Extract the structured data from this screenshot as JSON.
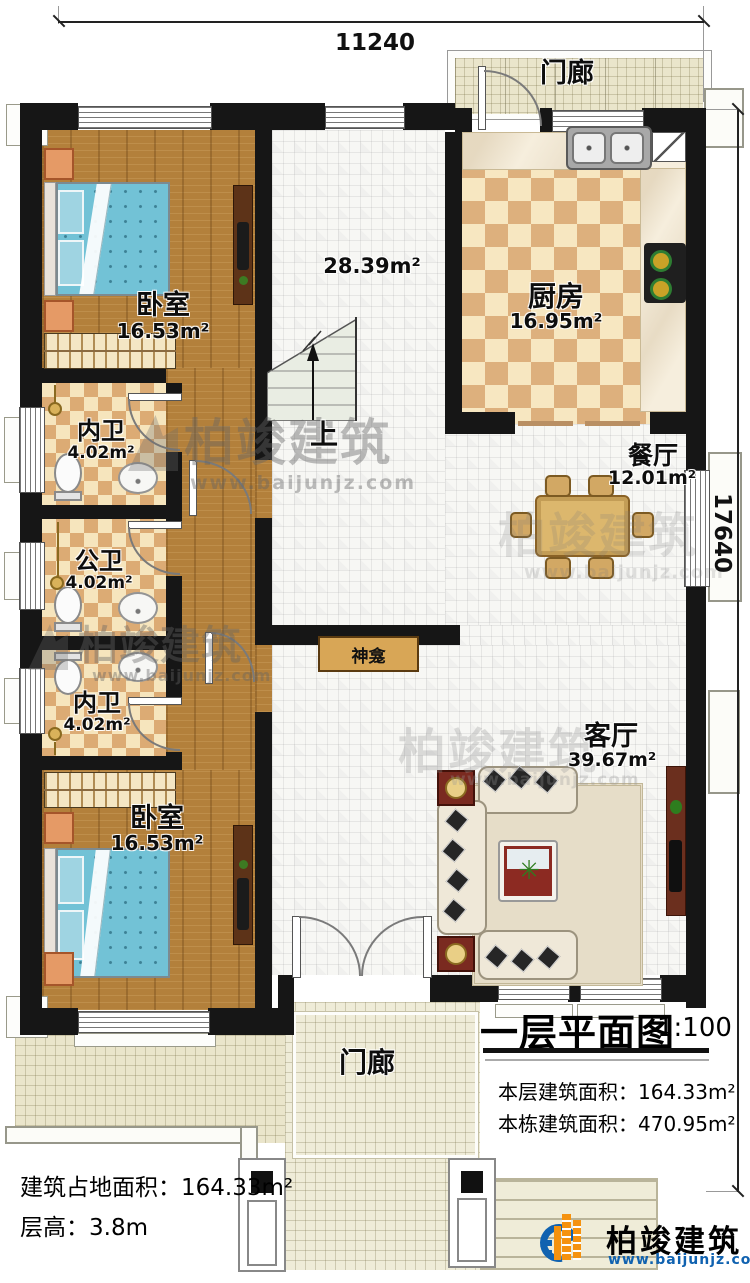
{
  "dimensions": {
    "top": "11240",
    "right": "17640"
  },
  "rooms": {
    "porch_top": {
      "name": "门廊"
    },
    "kitchen": {
      "name": "厨房",
      "area": "16.95m²"
    },
    "bedroom_top": {
      "name": "卧室",
      "area": "16.53m²"
    },
    "hall": {
      "area": "28.39m²"
    },
    "bath_en_suite_1": {
      "name": "内卫",
      "area": "4.02m²"
    },
    "bath_public": {
      "name": "公卫",
      "area": "4.02m²"
    },
    "bath_en_suite_2": {
      "name": "内卫",
      "area": "4.02m²"
    },
    "bedroom_bottom": {
      "name": "卧室",
      "area": "16.53m²"
    },
    "dining": {
      "name": "餐厅",
      "area": "12.01m²"
    },
    "living": {
      "name": "客厅",
      "area": "39.67m²"
    },
    "shrine": {
      "name": "神龛"
    },
    "stairs": {
      "up": "上"
    },
    "porch_bottom": {
      "name": "门廊"
    }
  },
  "title_block": {
    "title": "一层平面图",
    "scale": "1:100",
    "floor_area_label": "本层建筑面积：",
    "floor_area": "164.33m²",
    "building_area_label": "本栋建筑面积：",
    "building_area": "470.95m²"
  },
  "site_info": {
    "footprint_label": "建筑占地面积：",
    "footprint": "164.33m²",
    "floor_height_label": "层高：",
    "floor_height": "3.8m"
  },
  "brand": {
    "name": "柏竣建筑",
    "site": "www.baijunjz.com"
  },
  "watermark": {
    "name": "柏竣建筑",
    "site": "www.baijunjz.com"
  },
  "colors": {
    "wall": "#161616",
    "wood": "#b3803b",
    "checker_tan": "#dcab74",
    "brand_blue": "#1062b0",
    "brand_orange": "#f5920f"
  }
}
